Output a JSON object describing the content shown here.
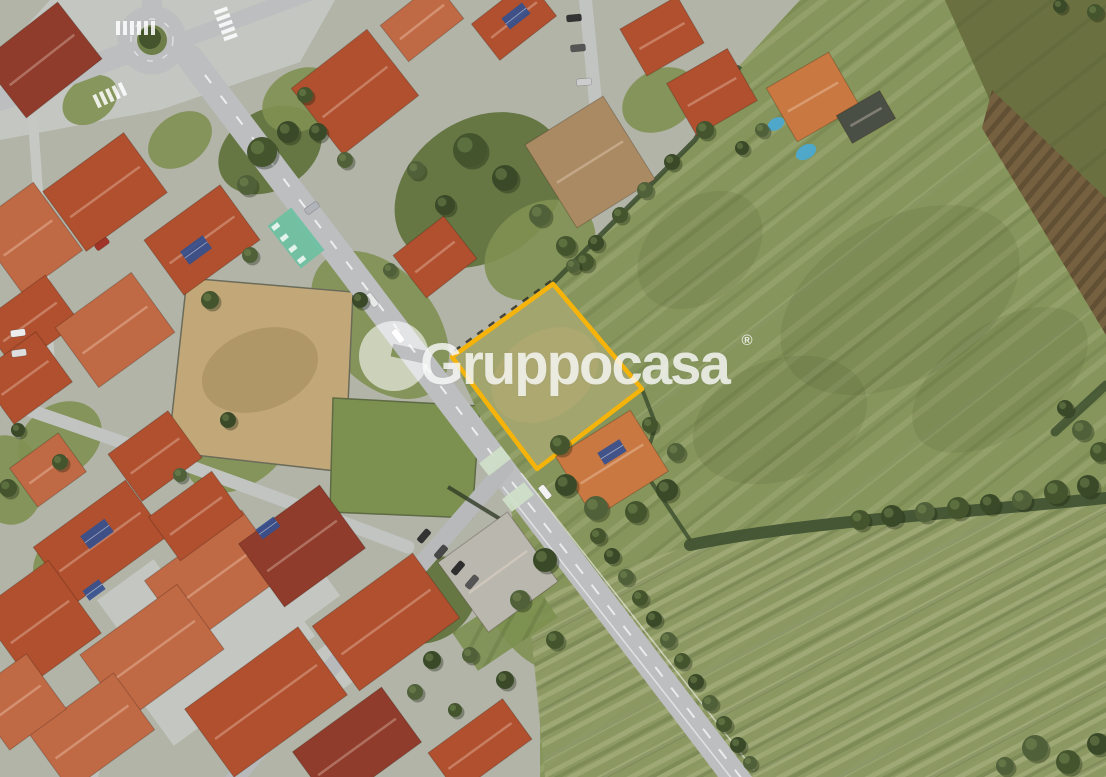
{
  "watermark": {
    "brand": "Gruppocasa",
    "trademark": "®",
    "color": "#FFFFFF"
  },
  "colors": {
    "parcel_outline": "#F6B40A",
    "parcel_fill": "#A2A56D",
    "field_green": "#86955B",
    "field_olive": "#6A7040",
    "field_tilled": "#75603F",
    "field_bottom": "#8C9963",
    "paddock_tan": "#C2A878",
    "paddock_green": "#7C9050",
    "road": "#BCBEC0",
    "pavement": "#C4C6C1",
    "lawn": "#7F9052",
    "lawn_dark": "#5D7038",
    "tree": "#44552E",
    "hedge": "#3E5030",
    "roof_terracotta": "#B0502F",
    "roof_orange": "#C06A45",
    "roof_bright_orange": "#C87840",
    "roof_dark_red": "#8F3C2C",
    "roof_tan": "#A98A63",
    "roof_gray": "#B9B7AE",
    "shed_dark": "#4A4F46",
    "solar_panel": "#35508F",
    "pool_blue": "#4FA8C9",
    "bike_crossing_green": "#66C2A0",
    "crosswalk_pale_green": "#CFE0C8",
    "road_marking": "#FFFFFF"
  }
}
